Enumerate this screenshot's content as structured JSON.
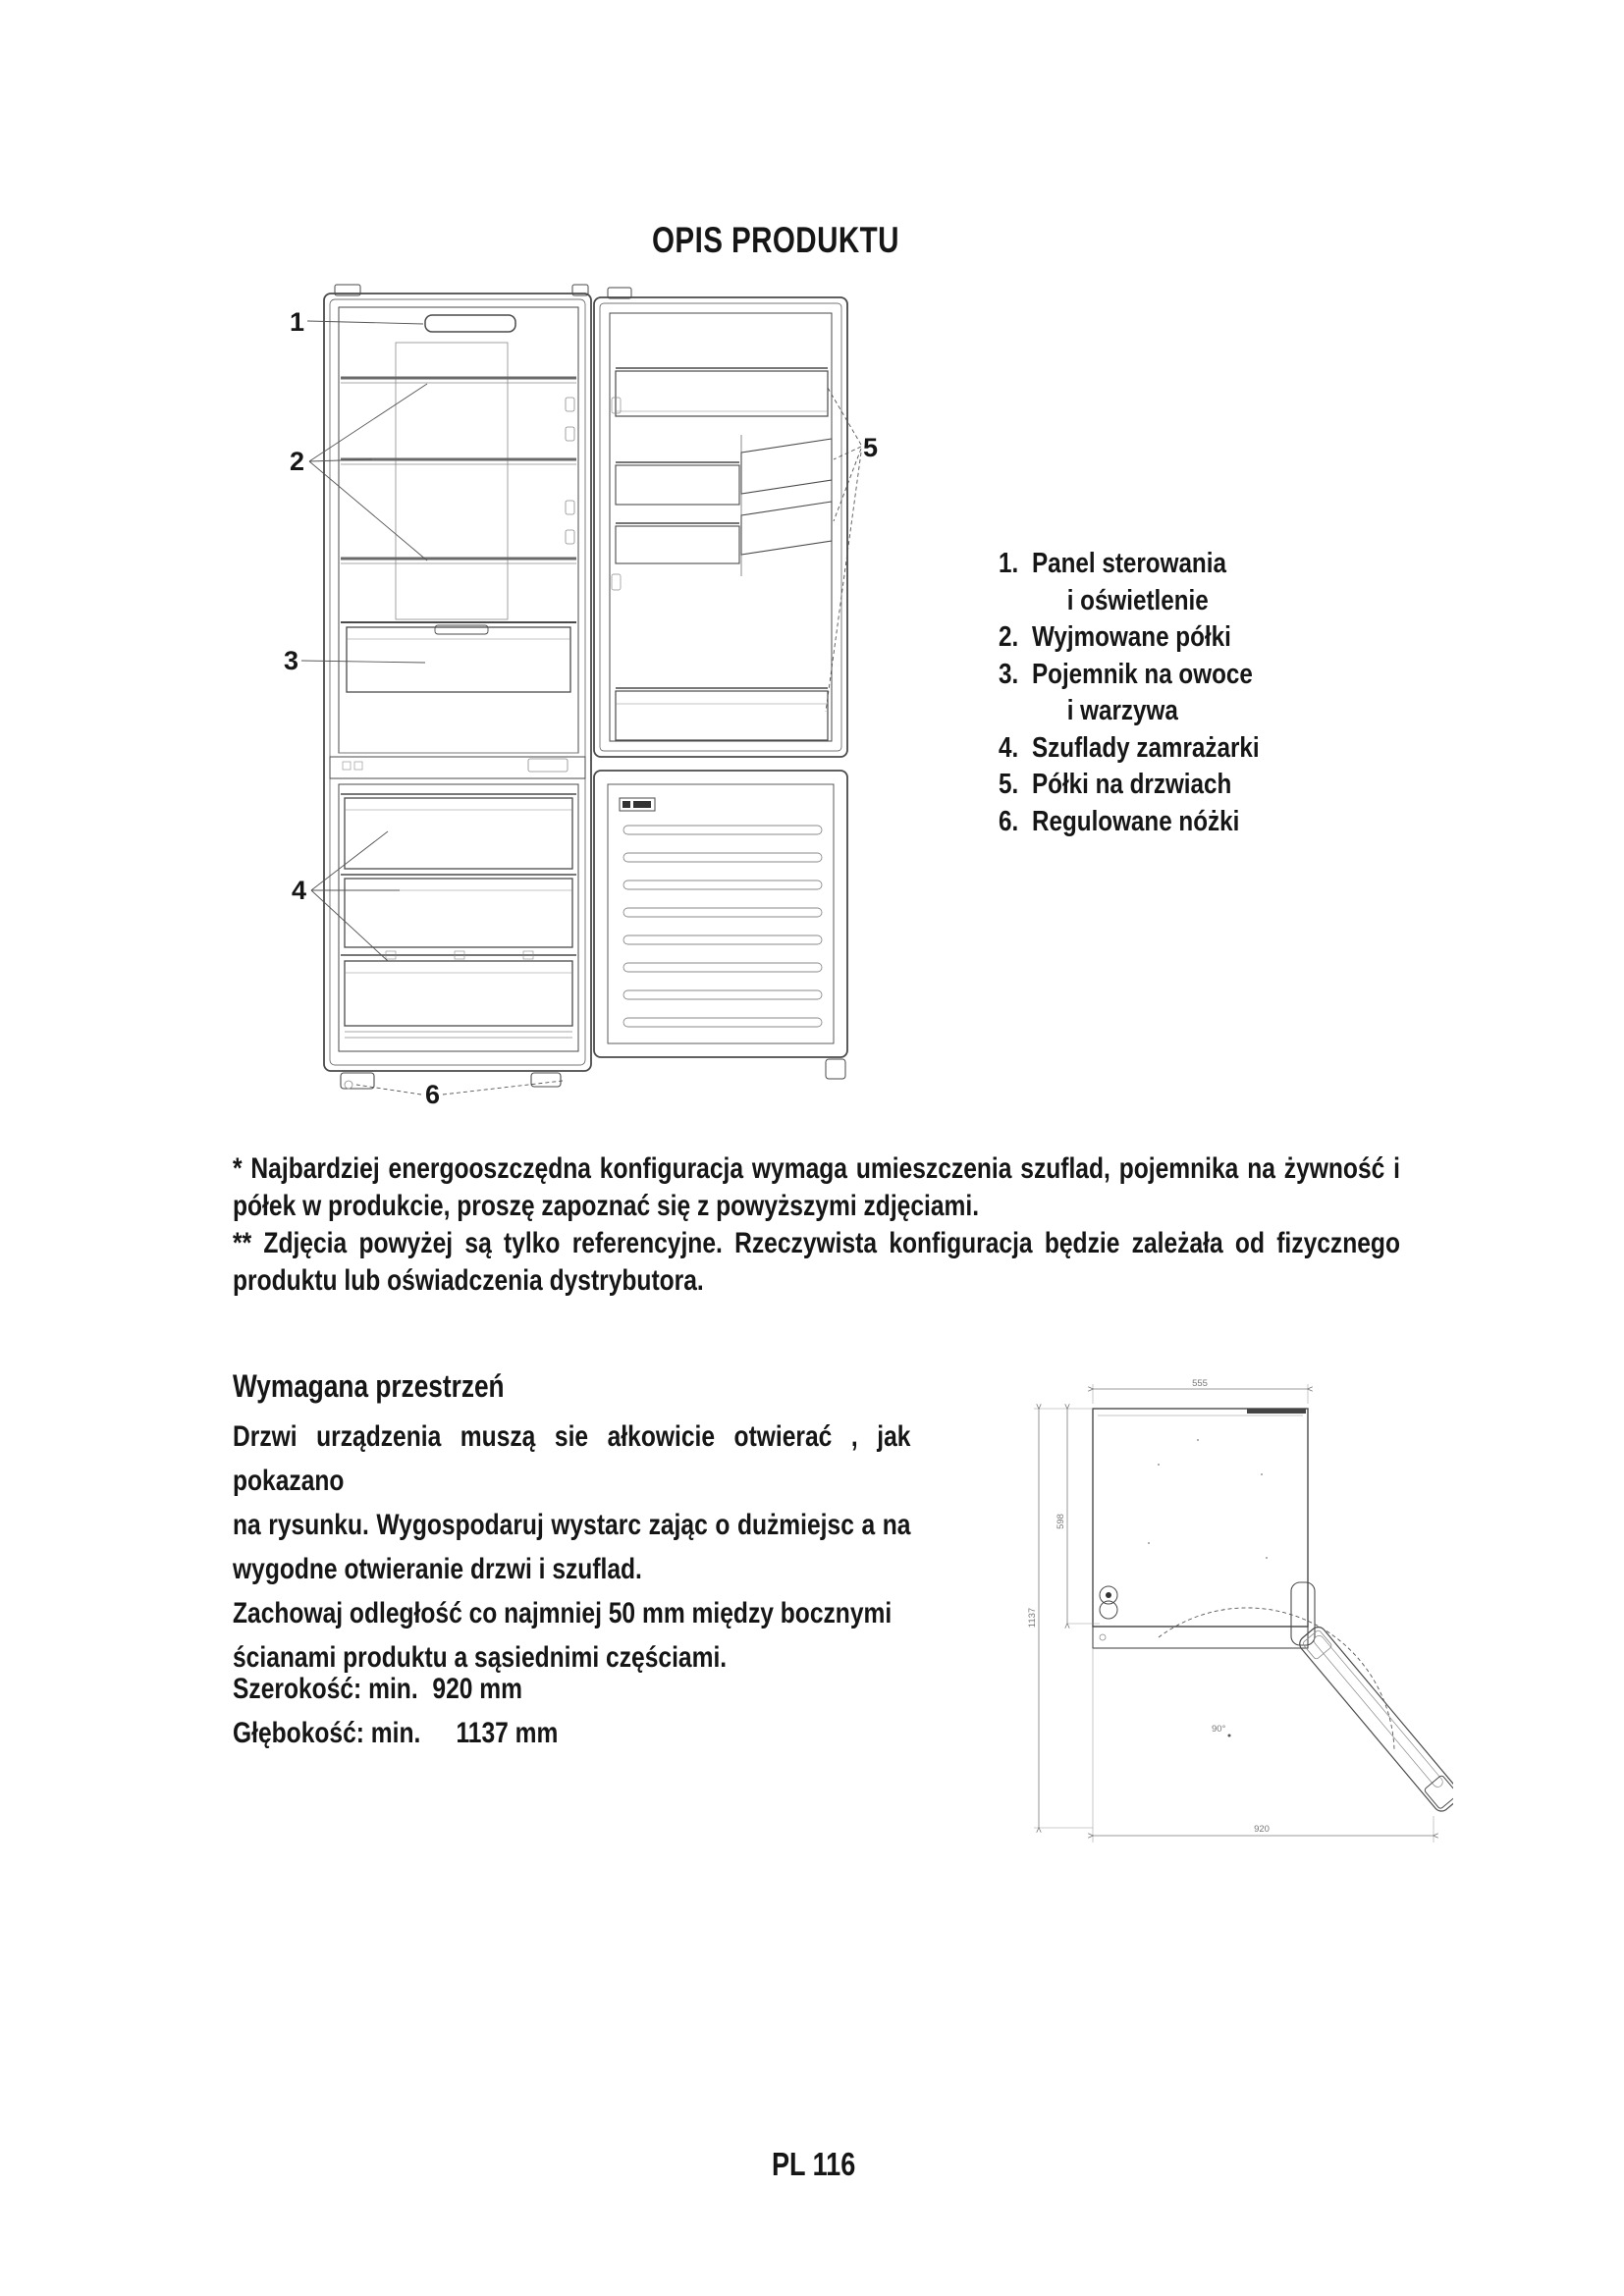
{
  "page": {
    "title": "OPIS PRODUKTU",
    "page_number": "PL 116"
  },
  "product_diagram": {
    "callouts": [
      "1",
      "2",
      "3",
      "4",
      "5",
      "6"
    ]
  },
  "parts_list": {
    "items": [
      {
        "num": "1.",
        "label": "Panel sterowania",
        "label2": "i oświetlenie"
      },
      {
        "num": "2.",
        "label": "Wyjmowane półki"
      },
      {
        "num": "3.",
        "label": "Pojemnik na owoce",
        "label2": "i warzywa"
      },
      {
        "num": "4.",
        "label": "Szuflady zamrażarki"
      },
      {
        "num": "5.",
        "label": "Półki na drzwiach"
      },
      {
        "num": "6.",
        "label": "Regulowane nóżki"
      }
    ]
  },
  "notes": {
    "l1": "* Najbardziej energooszczędna konfiguracja wymaga umieszczenia szuflad, pojemnika na żywność i",
    "l2": "półek w produkcie, proszę zapoznać się z powyższymi zdjęciami.",
    "l3": "** Zdjęcia powyżej są tylko referencyjne. Rzeczywista konfiguracja będzie zależała od fizycznego",
    "l4": "produktu lub oświadczenia dystrybutora."
  },
  "required_space": {
    "heading": "Wymagana przestrzeń",
    "l1": "Drzwi urządzenia muszą sie ałkowicie otwierać , jak pokazano",
    "l2": "na rysunku. Wygospodaruj wystarc zając o dużmiejsc a na",
    "l3": "wygodne otwieranie drzwi i szuflad.",
    "l4": "Zachowaj odległość co najmniej 50 mm między bocznymi",
    "l5": "ścianami produktu a sąsiednimi częściami.",
    "width_label": "Szerokość: min.",
    "width_value": "920 mm",
    "depth_label": "Głębokość: min.",
    "depth_value": "1137 mm"
  },
  "space_diagram": {
    "dim_top": "555",
    "dim_depth_cabinet": "598",
    "dim_depth_total": "1137",
    "dim_width_total": "920",
    "door_angle": "90°"
  }
}
